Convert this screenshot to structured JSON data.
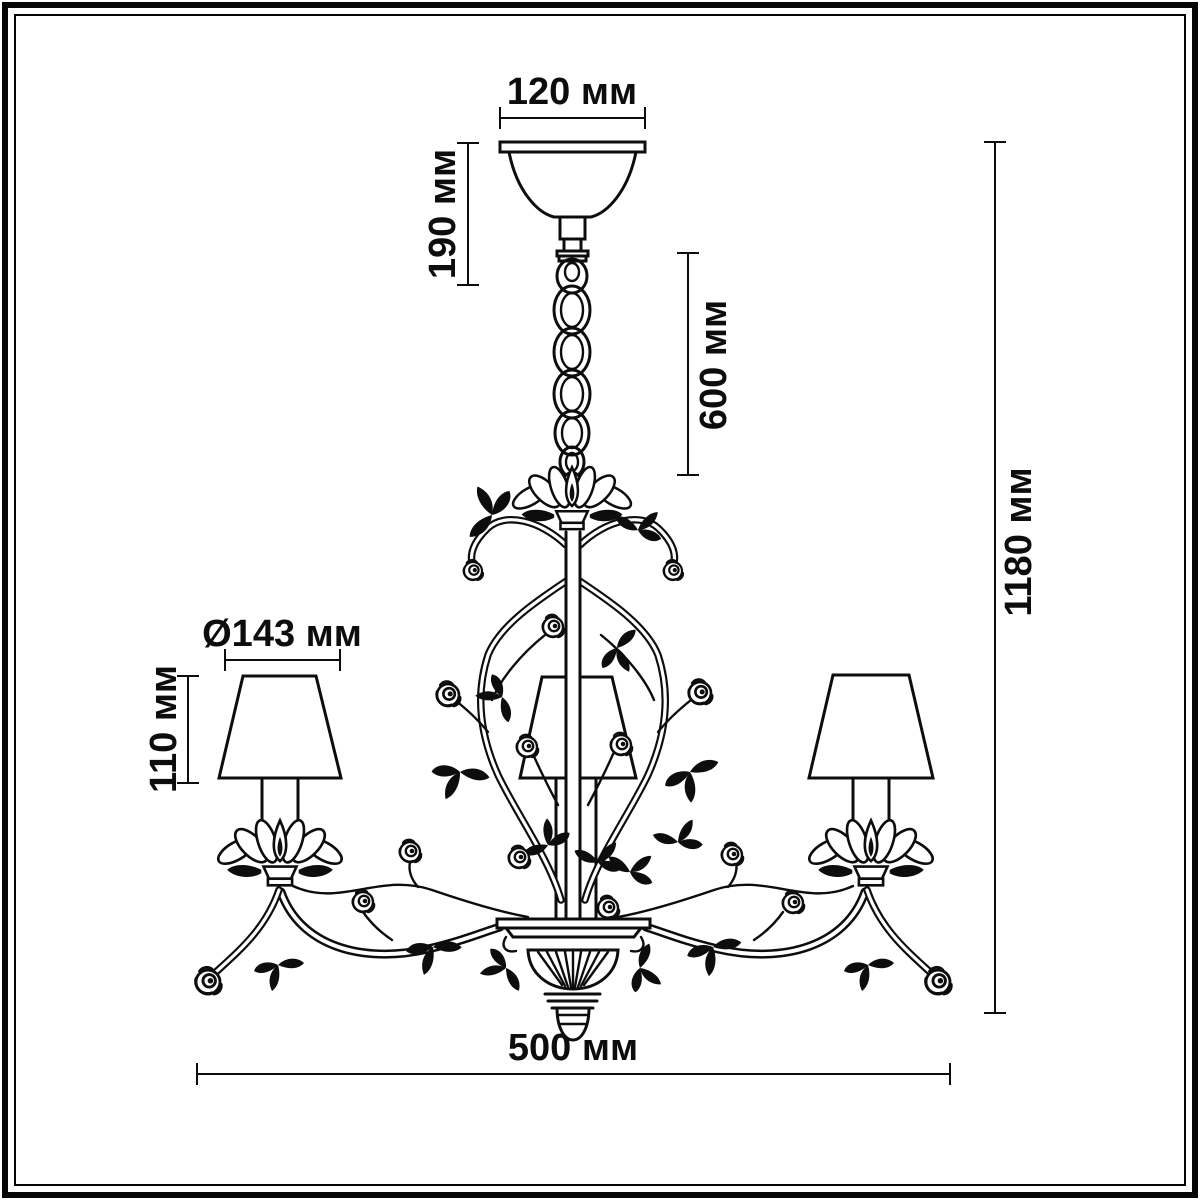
{
  "drawing": {
    "subject_colors": {
      "ink": "#0d0d0d",
      "background": "#ffffff",
      "frame": "#060606"
    },
    "unit": "мм"
  },
  "dimensions": {
    "canopy_width": {
      "label": "120 мм"
    },
    "canopy_height": {
      "label": "190 мм"
    },
    "chain_length": {
      "label": "600 мм"
    },
    "total_height": {
      "label": "1180 мм"
    },
    "shade_diameter": {
      "label": "Ø143 мм"
    },
    "shade_height": {
      "label": "110 мм"
    },
    "total_width": {
      "label": "500 мм"
    }
  }
}
